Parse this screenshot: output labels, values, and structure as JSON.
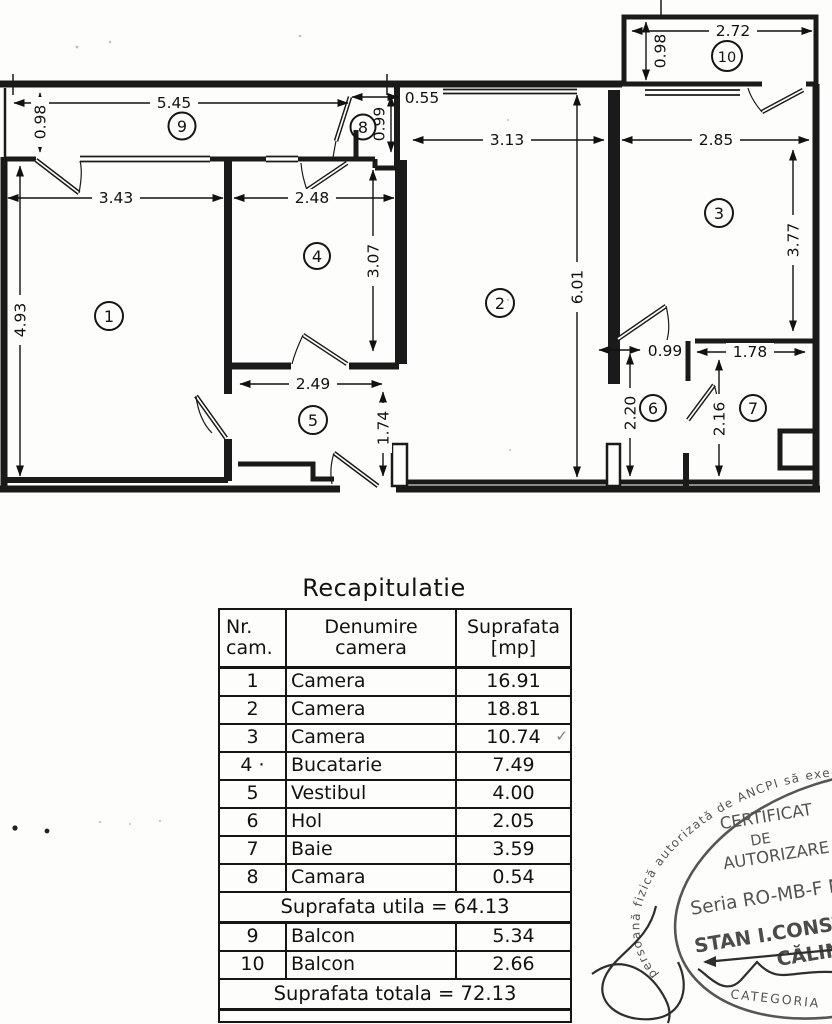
{
  "plan": {
    "rooms": [
      {
        "num": "1"
      },
      {
        "num": "2"
      },
      {
        "num": "3"
      },
      {
        "num": "4"
      },
      {
        "num": "5"
      },
      {
        "num": "6"
      },
      {
        "num": "7"
      },
      {
        "num": "8"
      },
      {
        "num": "9"
      },
      {
        "num": "10"
      }
    ],
    "dims": {
      "balc9_w": "5.45",
      "balc9_h": "0.98",
      "cam8_w": "0.55",
      "cam8_h": "0.99",
      "room1_w": "3.43",
      "room1_h": "4.93",
      "room4_w": "2.48",
      "room4_h": "3.07",
      "room2_w": "3.13",
      "room2_h": "6.01",
      "balc10_w": "2.72",
      "balc10_h": "0.98",
      "room3_w": "2.85",
      "room3_h": "3.77",
      "vest_w": "2.49",
      "vest_h": "1.74",
      "hol_w": "0.99",
      "hol_h": "2.20",
      "baie_w": "1.78",
      "baie_h": "2.16"
    }
  },
  "table": {
    "title": "Recapitulatie",
    "header": {
      "c1a": "Nr.",
      "c1b": "cam.",
      "c2a": "Denumire",
      "c2b": "camera",
      "c3a": "Suprafata",
      "c3b": "[mp]"
    },
    "rows": [
      {
        "nr": "1",
        "name": "Camera",
        "area": "16.91"
      },
      {
        "nr": "2",
        "name": "Camera",
        "area": "18.81"
      },
      {
        "nr": "3",
        "name": "Camera",
        "area": "10.74",
        "check": "✓"
      },
      {
        "nr": "4 ·",
        "name": "Bucatarie",
        "area": "7.49"
      },
      {
        "nr": "5",
        "name": "Vestibul",
        "area": "4.00"
      },
      {
        "nr": "6",
        "name": "Hol",
        "area": "2.05"
      },
      {
        "nr": "7",
        "name": "Baie",
        "area": "3.59"
      },
      {
        "nr": "8",
        "name": "Camara",
        "area": "0.54"
      }
    ],
    "subtotal": "Suprafata utila = 64.13",
    "rows2": [
      {
        "nr": "9",
        "name": "Balcon",
        "area": "5.34"
      },
      {
        "nr": "10",
        "name": "Balcon",
        "area": "2.66"
      }
    ],
    "total": "Suprafata totala = 72.13"
  },
  "stamp": {
    "ring_text": "persoană fizică autorizată de ANCPI să execute lucră",
    "line1": "CERTIFICAT",
    "line2": "DE",
    "line3": "AUTORIZARE",
    "line4": "Seria RO-MB-F Nr",
    "name1": "STAN I.CONST",
    "name2": "CĂLIN",
    "category": "CATEGORIA"
  }
}
